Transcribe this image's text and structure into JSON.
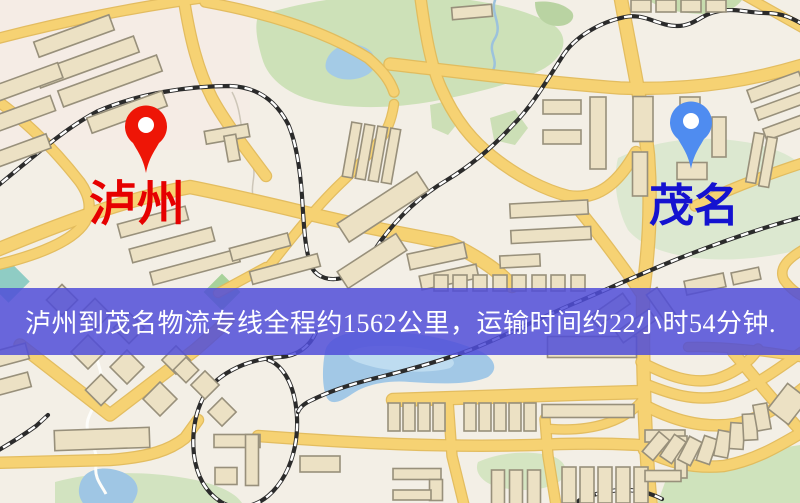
{
  "banner": {
    "text": "泸州到茂名物流专线全程约1562公里，运输时间约22小时54分钟.",
    "background": "#504ed8",
    "opacity": 0.85,
    "text_color": "#ffffff"
  },
  "markers": {
    "origin": {
      "name": "luzhou",
      "label": "泸州",
      "label_color": "#e60000",
      "pin_color": "#ee1506",
      "pin_style": "red-teardrop"
    },
    "destination": {
      "name": "maoming",
      "label": "茂名",
      "label_color": "#1412d0",
      "pin_color": "#4f8cf0",
      "pin_style": "blue-teardrop"
    }
  },
  "map": {
    "background": "#f3efe6",
    "road_fill": "#f6d273",
    "road_edge": "#e2b959",
    "building_fill": "#ece1c4",
    "building_stroke": "#98907b",
    "railway": "#2b2b2b",
    "water": "#a2c8e6",
    "park": "#cde1b8"
  }
}
